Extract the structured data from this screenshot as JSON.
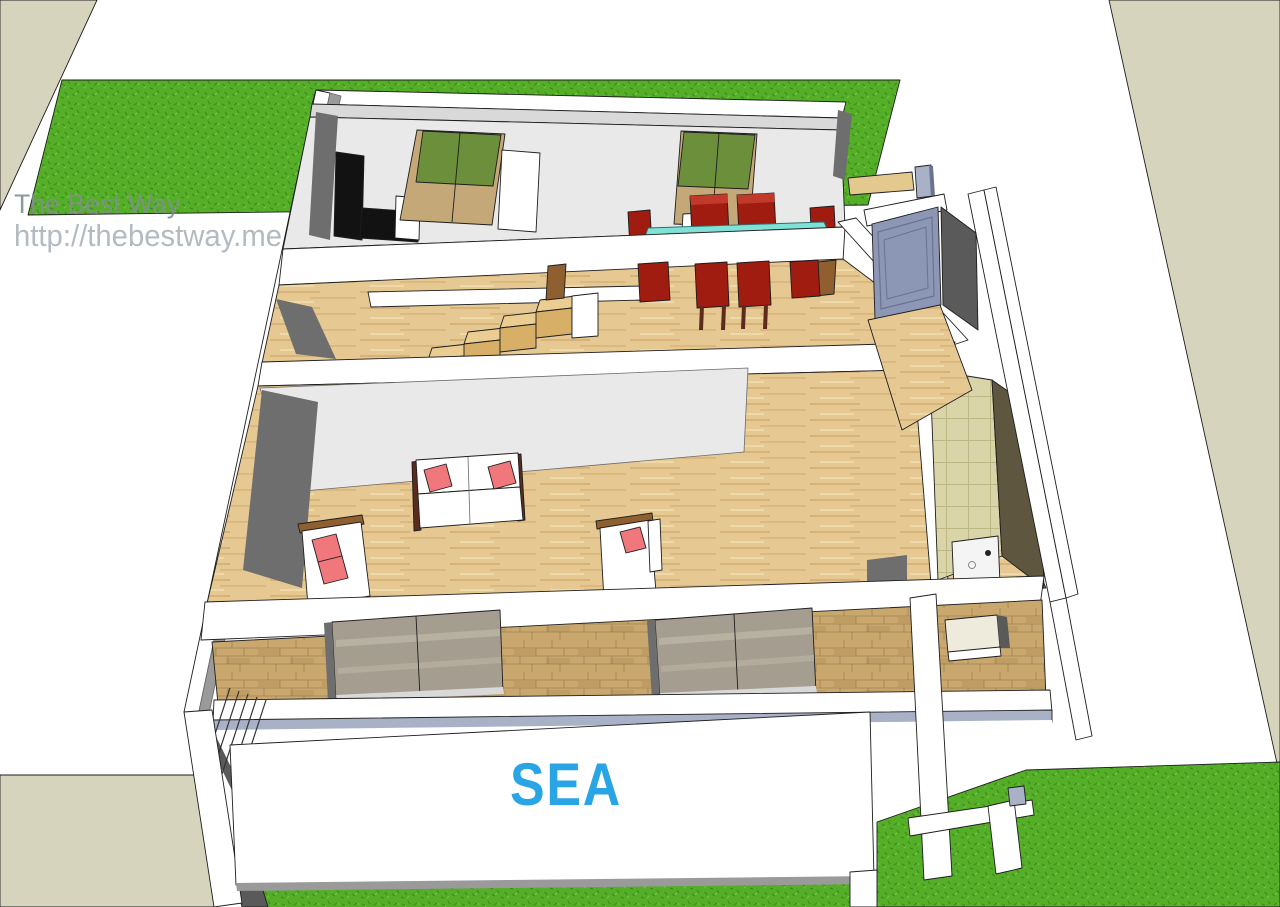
{
  "watermark": {
    "line1": "The Best Way",
    "line2": "http://thebestway.me"
  },
  "labels": {
    "sea": "SEA"
  },
  "palette": {
    "grass": "#54AE27",
    "grass_dark": "#3F8C1A",
    "grass_light": "#74C93E",
    "beige": "#D7D4BD",
    "sand": "#E3C98E",
    "wood": "#E6C893",
    "wood_dark": "#C9A263",
    "wood_mid": "#D8B478",
    "wood_light": "#F0D9A8",
    "step": "#D7AF66",
    "step_top": "#EBCD92",
    "stone": "#C9A76D",
    "stone_dark": "#8F744A",
    "stone_shade": "#B8945A",
    "tile": "#DAD4A9",
    "tile_line": "#BDB784",
    "glass": "#A59E90",
    "glass_light": "#BCB5A6",
    "wall_white": "#FFFFFF",
    "wall_light": "#E9E9E9",
    "wall_mid": "#D9D9D9",
    "wall_gray": "#6E6E6E",
    "wall_darkgray": "#5A5A5A",
    "edge_gray": "#9A9A9A",
    "olive": "#5F5640",
    "black": "#121212",
    "chair_red": "#A01B10",
    "chair_red_light": "#C0392B",
    "chair_leg": "#5C2B1E",
    "table_leg": "#8F5F30",
    "table_glass": "#98A0A0",
    "pillow": "#F0777B",
    "teal": "#7FE2D9",
    "teal_dark": "#2E6F68",
    "green_door": "#6C8F3C",
    "wardrobe_tan": "#C5A878",
    "door_blue": "#8C96B5",
    "door_blue_dark": "#6A7390",
    "strip_blue": "#A9B1C7",
    "window_in": "#EFEBDC",
    "sink": "#F4F4F4",
    "sea_blue": "#29A4E5",
    "watermark1": "#82908C",
    "watermark2": "#B3BBC2"
  }
}
